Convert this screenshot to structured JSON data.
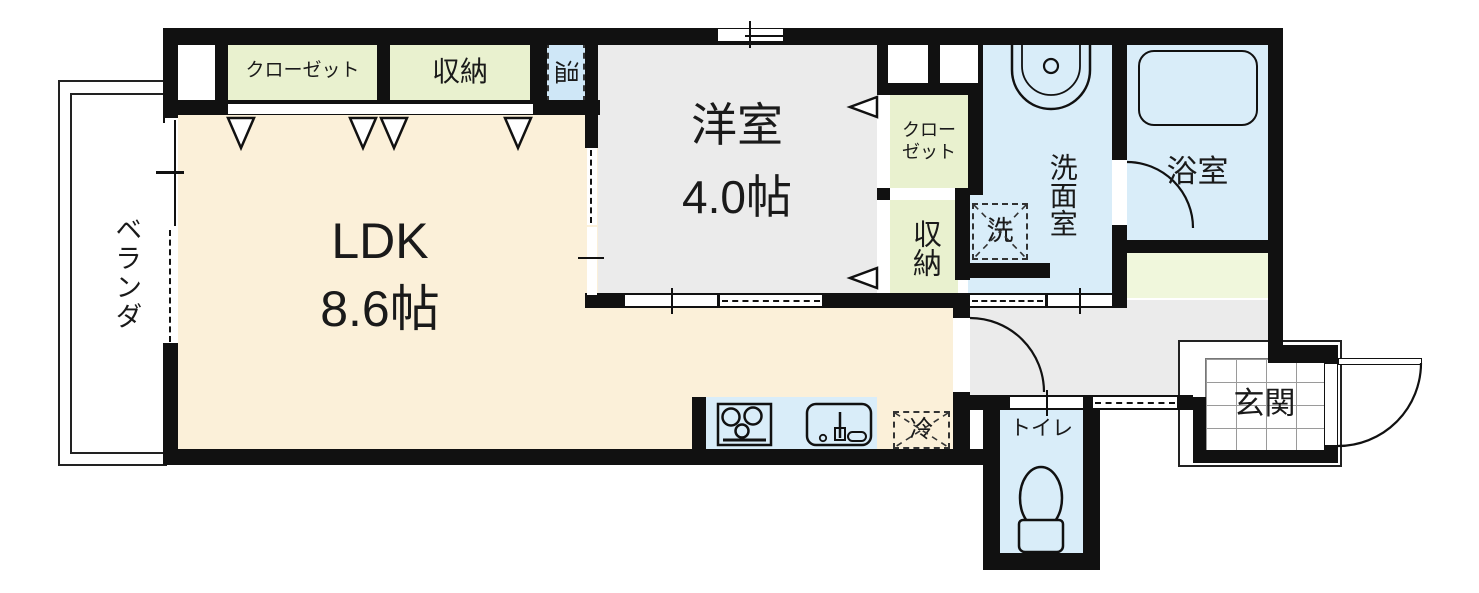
{
  "plan": {
    "ldk": {
      "name": "LDK",
      "area": "8.6帖"
    },
    "western_room": {
      "name": "洋室",
      "area": "4.0帖"
    },
    "closet_top": {
      "label": "クローゼット"
    },
    "storage_top": {
      "label": "収納"
    },
    "water_heater": {
      "label": "温"
    },
    "closet_side": {
      "line1": "クロー",
      "line2": "ゼット"
    },
    "storage_side": {
      "label": "収納"
    },
    "laundry_pan": {
      "label": "洗"
    },
    "washroom": {
      "label": "洗面室"
    },
    "bathroom": {
      "label": "浴室"
    },
    "refrigerator": {
      "label": "冷"
    },
    "toilet": {
      "label": "トイレ"
    },
    "entrance": {
      "label": "玄関"
    },
    "veranda": {
      "label": "ベランダ"
    }
  },
  "colors": {
    "wall": "#111111",
    "ldk_floor": "#FBF0D9",
    "closet_floor": "#E9F1CF",
    "water_floor": "#D9EDF9",
    "gray_floor": "#EBEBEB",
    "strip_floor": "#F0F7DC",
    "background": "#FFFFFF"
  }
}
